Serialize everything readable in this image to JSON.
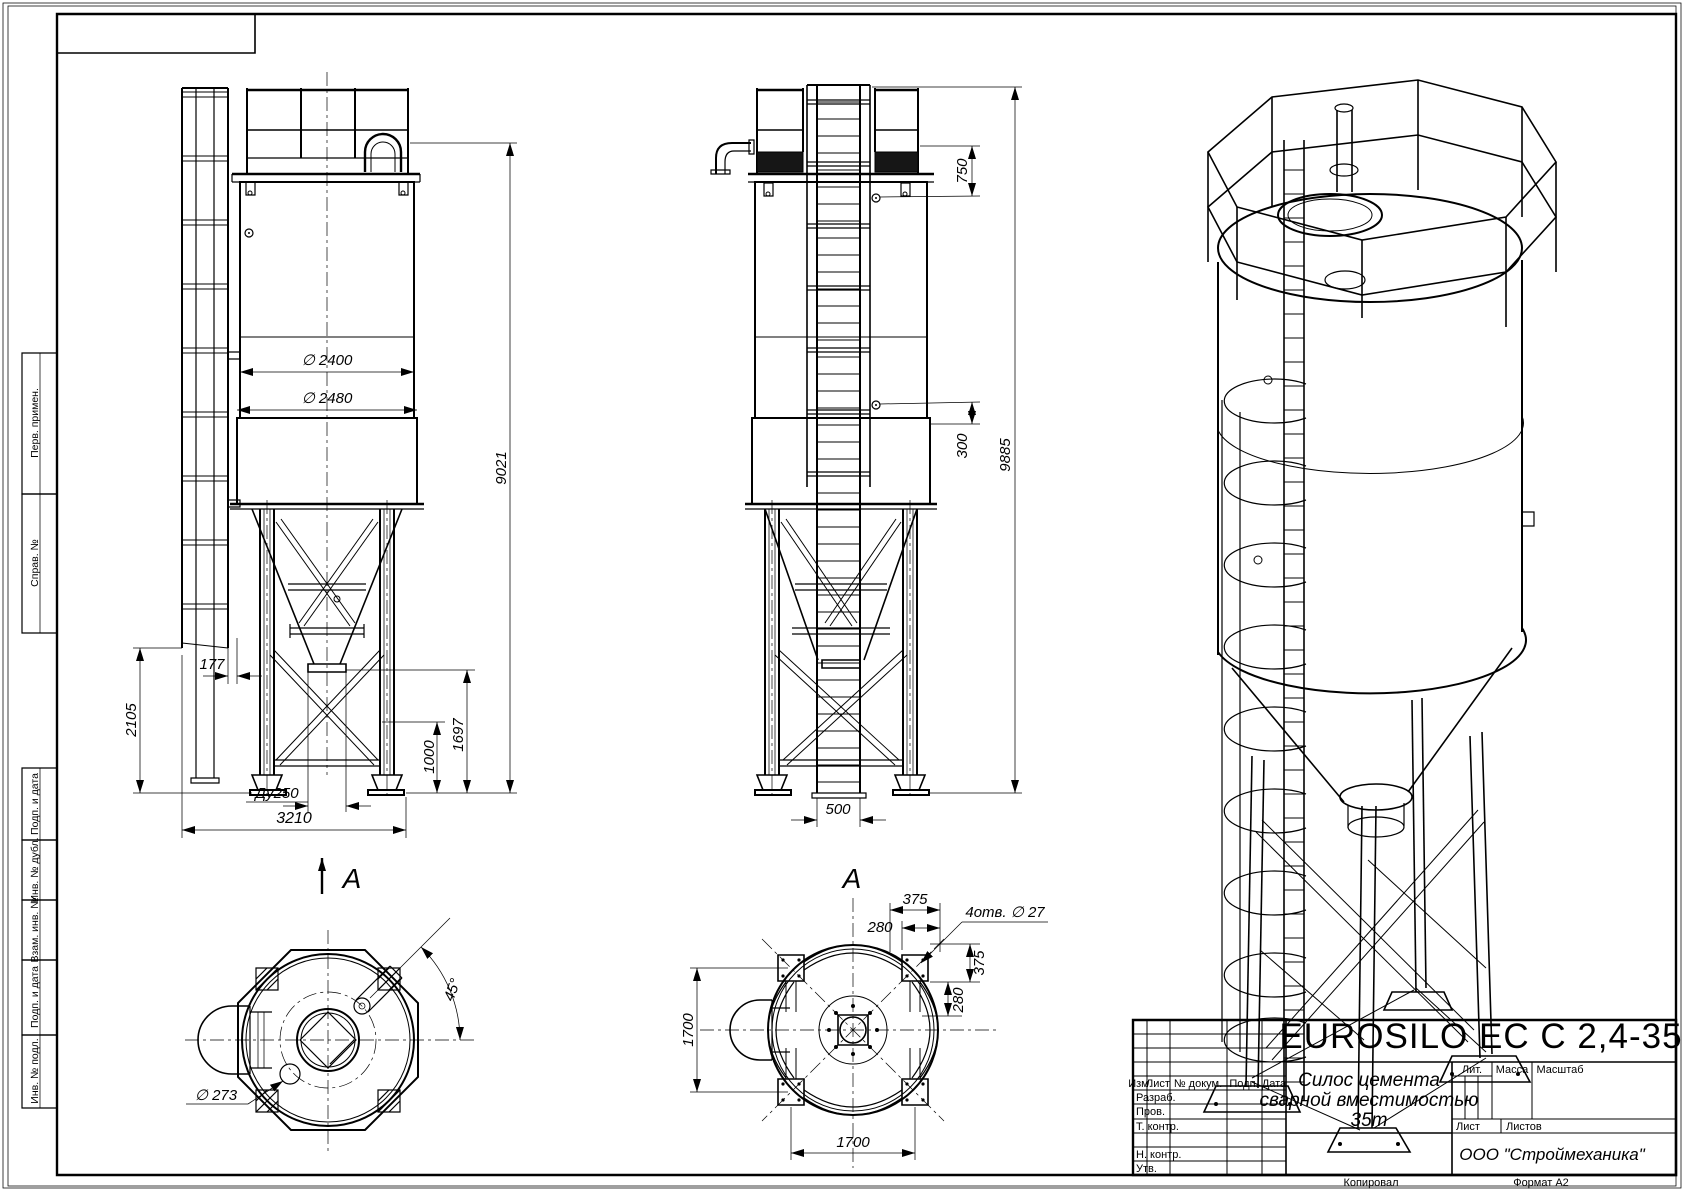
{
  "sheet": {
    "footer": {
      "kopiroval": "Копировал",
      "format": "Формат А2"
    }
  },
  "title_block": {
    "designation": "EUROSILO EC C 2,4-35",
    "name_line1": "Силос цемента",
    "name_line2": "сварной вместимостью",
    "name_line3": "35m",
    "headers": {
      "izm": "Изм.",
      "list": "Лист",
      "doc_no": "№ докум.",
      "podp": "Подп.",
      "data": "Дата"
    },
    "rows": {
      "razrab": "Разраб.",
      "prov": "Пров.",
      "t_kontr": "Т. контр.",
      "n_kontr": "Н. контр.",
      "utv": "Утв."
    },
    "right": {
      "lit": "Лит.",
      "massa": "Масса",
      "masshtab": "Масштаб",
      "list": "Лист",
      "listov": "Листов"
    },
    "company": "ООО \"Строймеханика\""
  },
  "margin_stamps": {
    "perv": "Перв. примен.",
    "sprav": "Справ. №",
    "podp1": "Подп. и дата",
    "inv_dubl": "Инв. № дубл.",
    "vzam": "Взам. инв. №",
    "podp2": "Подп. и дата",
    "inv_podl": "Инв. № подл."
  },
  "views": {
    "front": {
      "label": "А",
      "dims": {
        "d2400": "∅ 2400",
        "d2480": "∅ 2480",
        "h9021": "9021",
        "w177": "177",
        "h2105": "2105",
        "h1000": "1000",
        "h1697": "1697",
        "du250": "Ду250",
        "w3210": "3210"
      }
    },
    "side": {
      "label": "А",
      "dims": {
        "v750": "750",
        "v300": "300",
        "h9885": "9885",
        "w500": "500"
      }
    },
    "plan_front": {
      "dims": {
        "d273": "∅ 273",
        "a45": "45°"
      }
    },
    "plan_side": {
      "dims": {
        "t375": "375",
        "t280": "280",
        "r375": "375",
        "r280": "280",
        "l1700": "1700",
        "b1700": "1700",
        "holes": "4отв. ∅ 27"
      }
    }
  }
}
